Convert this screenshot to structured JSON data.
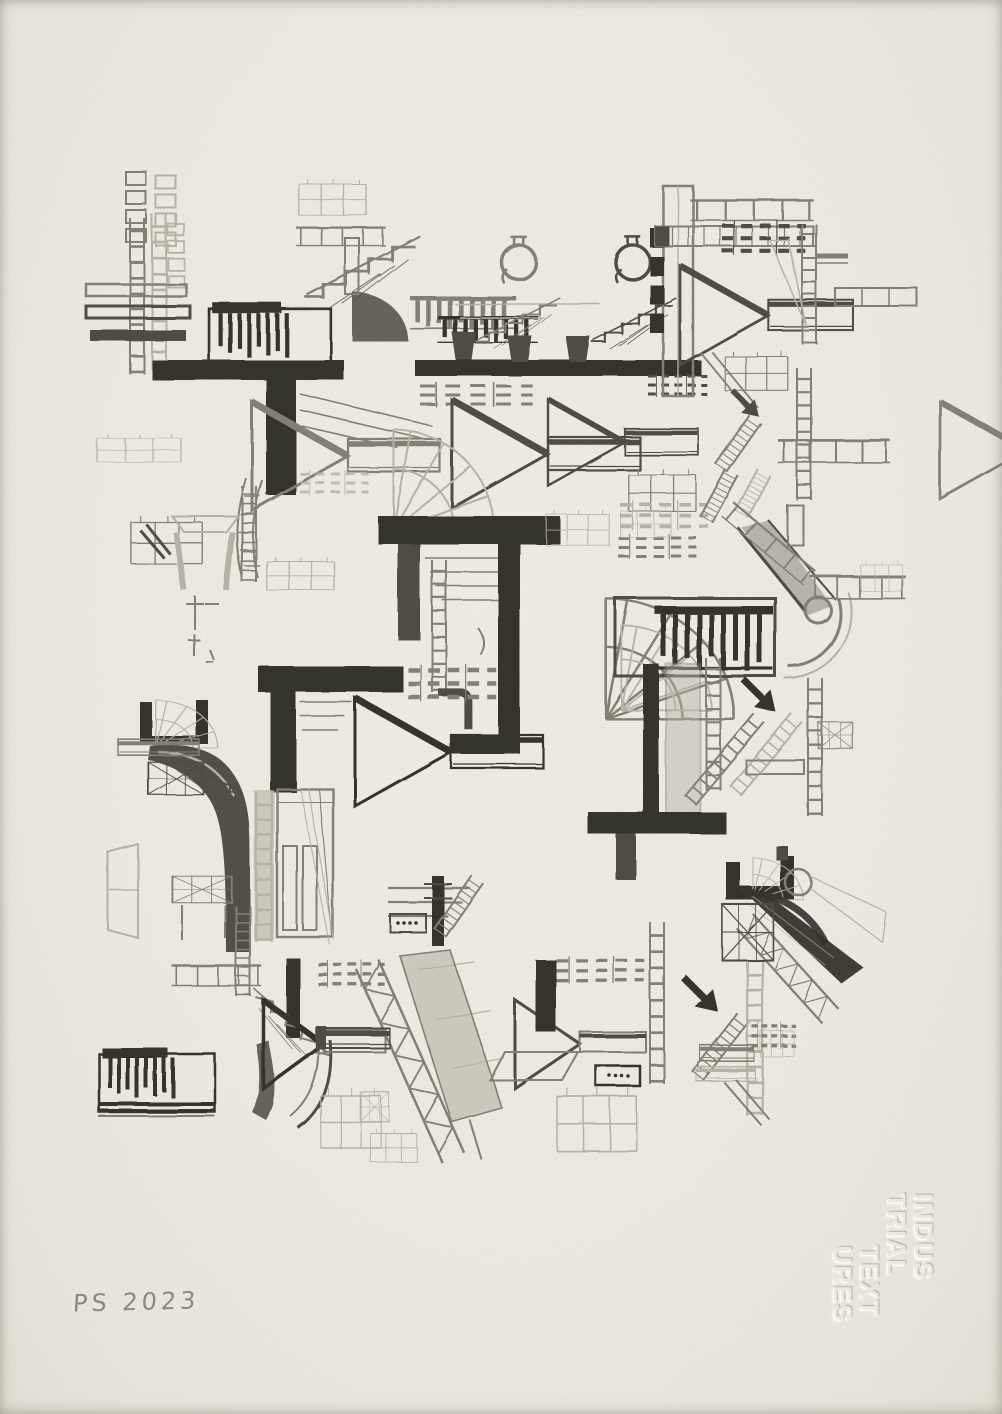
{
  "artwork": {
    "type": "pencil drawing on textured paper",
    "title": "Industrial Textures",
    "signature": "PS 2023",
    "emboss_lines": [
      "INDUS",
      "TRIAL",
      "TEXT",
      "URES"
    ]
  },
  "colors": {
    "paper": "#efece4",
    "graphite_darkest": "#2f2d28",
    "graphite_dark": "#4b4740",
    "graphite_mid": "#827d72",
    "graphite_light": "#b7b2a6",
    "signature_gray": "#8d887c",
    "emboss_tone": "#ebe8df"
  }
}
